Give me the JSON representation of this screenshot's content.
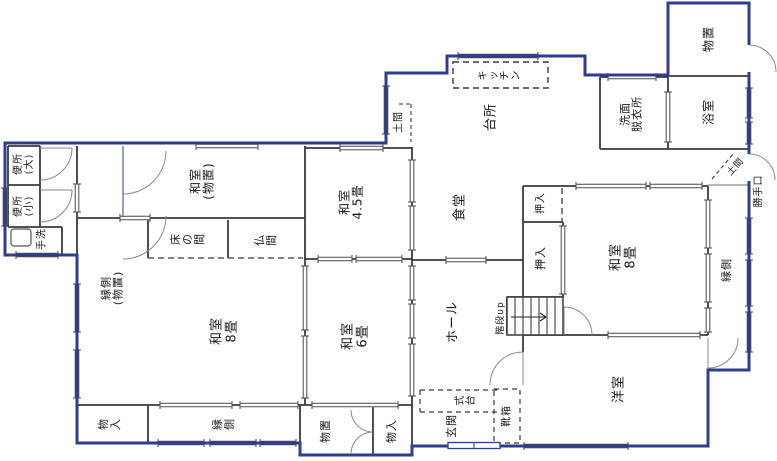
{
  "drawing": {
    "kind": "japanese-house-floor-plan",
    "colors": {
      "outer_wall": "#2e3e8e",
      "inner_wall": "#3b3b3b",
      "window_line": "#4a4a4a",
      "door_arc": "#8a8a8a",
      "label": "#1b1b1b",
      "paper": "#ffffff"
    }
  },
  "labels": [
    {
      "id": "benjo-dai",
      "text": "便所\n(大)",
      "x": 24,
      "y": 164,
      "mode": "col",
      "size": 10
    },
    {
      "id": "benjo-sho",
      "text": "便所\n(小)",
      "x": 24,
      "y": 206,
      "mode": "col",
      "size": 10
    },
    {
      "id": "tearai",
      "text": "手洗",
      "x": 42,
      "y": 239,
      "mode": "col",
      "size": 10
    },
    {
      "id": "washitsu-monooki",
      "text": "和室\n(物置)",
      "x": 203,
      "y": 181,
      "mode": "col",
      "size": 12
    },
    {
      "id": "washitsu-45",
      "text": "和室\n4.5畳",
      "x": 352,
      "y": 202,
      "mode": "col",
      "size": 12
    },
    {
      "id": "tokonoma",
      "text": "床の間",
      "x": 188,
      "y": 239,
      "mode": "row",
      "size": 11
    },
    {
      "id": "butsuma",
      "text": "仏間",
      "x": 266,
      "y": 240,
      "mode": "row",
      "size": 11
    },
    {
      "id": "engawa-monooki",
      "text": "縁側\n(物置)",
      "x": 113,
      "y": 288,
      "mode": "col",
      "size": 11
    },
    {
      "id": "washitsu-8-left",
      "text": "和室\n8畳",
      "x": 225,
      "y": 331,
      "mode": "col",
      "size": 13
    },
    {
      "id": "washitsu-6",
      "text": "和室\n6畳",
      "x": 356,
      "y": 336,
      "mode": "col",
      "size": 13
    },
    {
      "id": "monoire-bl",
      "text": "物入",
      "x": 110,
      "y": 424,
      "mode": "row",
      "size": 11
    },
    {
      "id": "engawa-bottom",
      "text": "縁側",
      "x": 224,
      "y": 424,
      "mode": "row",
      "size": 11
    },
    {
      "id": "monooki-bottom",
      "text": "物置",
      "x": 326,
      "y": 431,
      "mode": "col",
      "size": 11
    },
    {
      "id": "monoire-br",
      "text": "物入",
      "x": 392,
      "y": 431,
      "mode": "col",
      "size": 11
    },
    {
      "id": "shokudo",
      "text": "食堂",
      "x": 461,
      "y": 207,
      "mode": "col",
      "size": 13
    },
    {
      "id": "daidokoro",
      "text": "台所",
      "x": 492,
      "y": 117,
      "mode": "col",
      "size": 13
    },
    {
      "id": "kitchen",
      "text": "キッチン",
      "x": 500,
      "y": 75,
      "mode": "row",
      "size": 10
    },
    {
      "id": "doma-left",
      "text": "土間",
      "x": 399,
      "y": 122,
      "mode": "col",
      "size": 10
    },
    {
      "id": "senmen-datsuiijo",
      "text": "洗面\n脱衣所",
      "x": 632,
      "y": 114,
      "mode": "col",
      "size": 11
    },
    {
      "id": "monooki-top",
      "text": "物置",
      "x": 709,
      "y": 39,
      "mode": "col",
      "size": 12
    },
    {
      "id": "yokushitsu",
      "text": "浴室",
      "x": 709,
      "y": 112,
      "mode": "col",
      "size": 12
    },
    {
      "id": "katteguchi",
      "text": "勝手口",
      "x": 759,
      "y": 191,
      "mode": "col",
      "size": 10
    },
    {
      "id": "doma-right",
      "text": "土間",
      "x": 736,
      "y": 167,
      "mode": "diag",
      "rotate": -48,
      "size": 9
    },
    {
      "id": "engawa-right",
      "text": "縁側",
      "x": 727,
      "y": 270,
      "mode": "col",
      "size": 11
    },
    {
      "id": "oshiire-upper",
      "text": "押入",
      "x": 541,
      "y": 203,
      "mode": "col",
      "size": 10
    },
    {
      "id": "oshiire-lower",
      "text": "押入",
      "x": 541,
      "y": 258,
      "mode": "col",
      "size": 11
    },
    {
      "id": "washitsu-8-right",
      "text": "和室\n8畳",
      "x": 624,
      "y": 257,
      "mode": "col",
      "size": 13
    },
    {
      "id": "kaidan-up",
      "text": "階段up",
      "x": 501,
      "y": 318,
      "mode": "col",
      "size": 9
    },
    {
      "id": "hall",
      "text": "ホール",
      "x": 454,
      "y": 322,
      "mode": "col",
      "size": 13
    },
    {
      "id": "genkan",
      "text": "玄関",
      "x": 452,
      "y": 426,
      "mode": "col",
      "size": 11
    },
    {
      "id": "shikidai",
      "text": "式台",
      "x": 466,
      "y": 400,
      "mode": "row",
      "size": 10
    },
    {
      "id": "kutsubako",
      "text": "靴箱",
      "x": 507,
      "y": 416,
      "mode": "col",
      "size": 10
    },
    {
      "id": "yoshitsu",
      "text": "洋室",
      "x": 620,
      "y": 389,
      "mode": "col",
      "size": 13
    }
  ],
  "windows_h": [
    [
      146,
      196,
      258
    ],
    [
      148,
      340,
      383
    ],
    [
      56,
      458,
      538
    ],
    [
      77,
      608,
      656
    ],
    [
      186,
      576,
      646
    ],
    [
      186,
      650,
      702
    ],
    [
      259,
      318,
      352
    ],
    [
      259,
      356,
      402
    ],
    [
      260,
      446,
      486
    ],
    [
      335,
      608,
      700
    ],
    [
      405,
      160,
      232
    ],
    [
      405,
      240,
      298
    ],
    [
      405,
      312,
      398
    ],
    [
      443,
      158,
      204
    ],
    [
      443,
      210,
      256
    ],
    [
      443,
      260,
      296
    ],
    [
      446,
      524,
      628
    ],
    [
      255,
      16,
      58
    ],
    [
      218,
      120,
      150
    ]
  ],
  "windows_v": [
    [
      386,
      86,
      134
    ],
    [
      412,
      160,
      202
    ],
    [
      412,
      206,
      250
    ],
    [
      412,
      266,
      300
    ],
    [
      412,
      304,
      338
    ],
    [
      412,
      344,
      396
    ],
    [
      77,
      284,
      332
    ],
    [
      77,
      350,
      398
    ],
    [
      77,
      184,
      212
    ],
    [
      749,
      88,
      118
    ],
    [
      749,
      122,
      144
    ],
    [
      749,
      218,
      254
    ],
    [
      749,
      260,
      306
    ],
    [
      749,
      312,
      352
    ],
    [
      5,
      188,
      226
    ],
    [
      708,
      200,
      248
    ],
    [
      708,
      254,
      302
    ],
    [
      708,
      308,
      332
    ],
    [
      668,
      92,
      142
    ],
    [
      563,
      226,
      294
    ],
    [
      305,
      266,
      330
    ],
    [
      305,
      336,
      398
    ]
  ]
}
